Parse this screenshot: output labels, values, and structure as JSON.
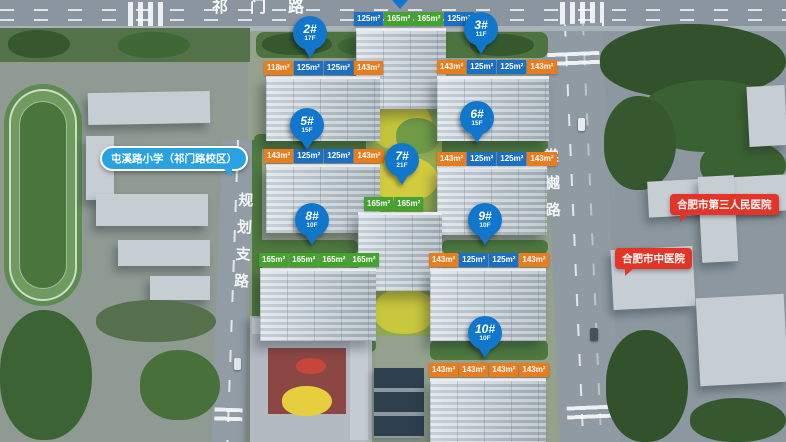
{
  "roads": {
    "top": "祁门路",
    "left": "规划支路",
    "right": "棠樾路"
  },
  "landmarks": {
    "school": "屯溪路小学（祁门路校区）",
    "hospital_third": "合肥市第三人民医院",
    "hospital_tcm": "合肥市中医院"
  },
  "colors": {
    "pin_blue": "#1077cd",
    "unit_orange": "#e87c1e",
    "unit_blue": "#1c6fc2",
    "unit_green": "#43a32e",
    "landmark_red": "#e23427",
    "landmark_blue": "#2aa2df"
  },
  "buildings": [
    {
      "id": "1#",
      "floors": "",
      "units": [
        {
          "area": "125m²",
          "type": "blue"
        },
        {
          "area": "165m²",
          "type": "green"
        },
        {
          "area": "165m²",
          "type": "green"
        },
        {
          "area": "125m²",
          "type": "blue"
        }
      ]
    },
    {
      "id": "2#",
      "floors": "17F",
      "units": [
        {
          "area": "118m²",
          "type": "orange"
        },
        {
          "area": "125m²",
          "type": "blue"
        },
        {
          "area": "125m²",
          "type": "blue"
        },
        {
          "area": "143m²",
          "type": "orange"
        }
      ]
    },
    {
      "id": "3#",
      "floors": "11F",
      "units": [
        {
          "area": "143m²",
          "type": "orange"
        },
        {
          "area": "125m²",
          "type": "blue"
        },
        {
          "area": "125m²",
          "type": "blue"
        },
        {
          "area": "143m²",
          "type": "orange"
        }
      ]
    },
    {
      "id": "5#",
      "floors": "15F",
      "units": [
        {
          "area": "143m²",
          "type": "orange"
        },
        {
          "area": "125m²",
          "type": "blue"
        },
        {
          "area": "125m²",
          "type": "blue"
        },
        {
          "area": "143m²",
          "type": "orange"
        }
      ]
    },
    {
      "id": "6#",
      "floors": "15F",
      "units": [
        {
          "area": "143m²",
          "type": "orange"
        },
        {
          "area": "125m²",
          "type": "blue"
        },
        {
          "area": "125m²",
          "type": "blue"
        },
        {
          "area": "143m²",
          "type": "orange"
        }
      ]
    },
    {
      "id": "7#",
      "floors": "21F",
      "units": [
        {
          "area": "165m²",
          "type": "green"
        },
        {
          "area": "165m²",
          "type": "green"
        }
      ]
    },
    {
      "id": "8#",
      "floors": "10F",
      "units": [
        {
          "area": "165m²",
          "type": "green"
        },
        {
          "area": "165m²",
          "type": "green"
        },
        {
          "area": "165m²",
          "type": "green"
        },
        {
          "area": "165m²",
          "type": "green"
        }
      ]
    },
    {
      "id": "9#",
      "floors": "10F",
      "units": [
        {
          "area": "143m²",
          "type": "orange"
        },
        {
          "area": "125m²",
          "type": "blue"
        },
        {
          "area": "125m²",
          "type": "blue"
        },
        {
          "area": "143m²",
          "type": "orange"
        }
      ]
    },
    {
      "id": "10#",
      "floors": "10F",
      "units": [
        {
          "area": "143m²",
          "type": "orange"
        },
        {
          "area": "143m²",
          "type": "orange"
        },
        {
          "area": "143m²",
          "type": "orange"
        },
        {
          "area": "143m²",
          "type": "orange"
        }
      ]
    }
  ]
}
